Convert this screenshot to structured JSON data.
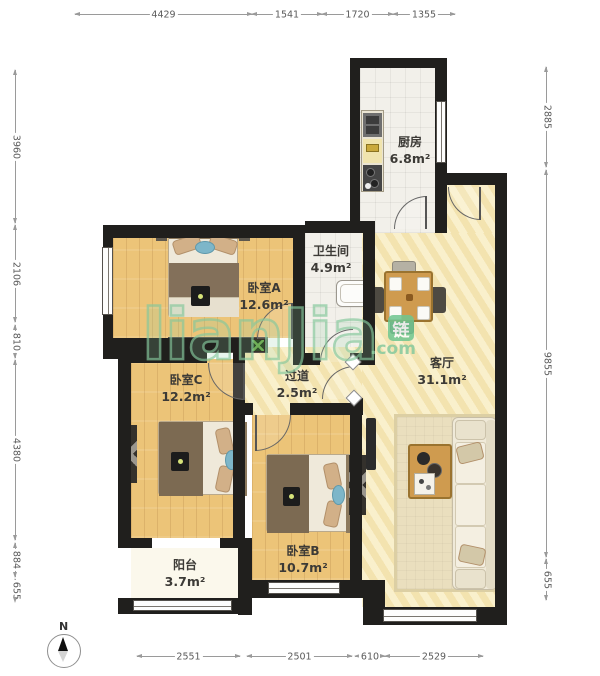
{
  "rooms": {
    "kitchen": {
      "name": "厨房",
      "area": "6.8m²"
    },
    "bathroom": {
      "name": "卫生间",
      "area": "4.9m²"
    },
    "bedroomA": {
      "name": "卧室A",
      "area": "12.6m²"
    },
    "living": {
      "name": "客厅",
      "area": "31.1m²"
    },
    "bedroomC": {
      "name": "卧室C",
      "area": "12.2m²"
    },
    "corridor": {
      "name": "过道",
      "area": "2.5m²"
    },
    "bedroomB": {
      "name": "卧室B",
      "area": "10.7m²"
    },
    "balcony": {
      "name": "阳台",
      "area": "3.7m²"
    }
  },
  "dimensions": {
    "top": [
      "4429",
      "1541",
      "1720",
      "1355"
    ],
    "left": [
      "3960",
      "2106",
      "810",
      "4380",
      "884",
      "655"
    ],
    "right": [
      "2885",
      "9855",
      "655"
    ],
    "bottom": [
      "2551",
      "2501",
      "610",
      "2529"
    ]
  },
  "compass": {
    "label": "N"
  },
  "watermark": {
    "brand": "lianJia",
    "logo": "链",
    "suffix": ".com"
  },
  "colors": {
    "wall": "#201f1d",
    "wood": "#ecc478",
    "hall": "#f6e8b9",
    "tile": "#f2f0ea",
    "watermark_green": "#86c89c"
  }
}
